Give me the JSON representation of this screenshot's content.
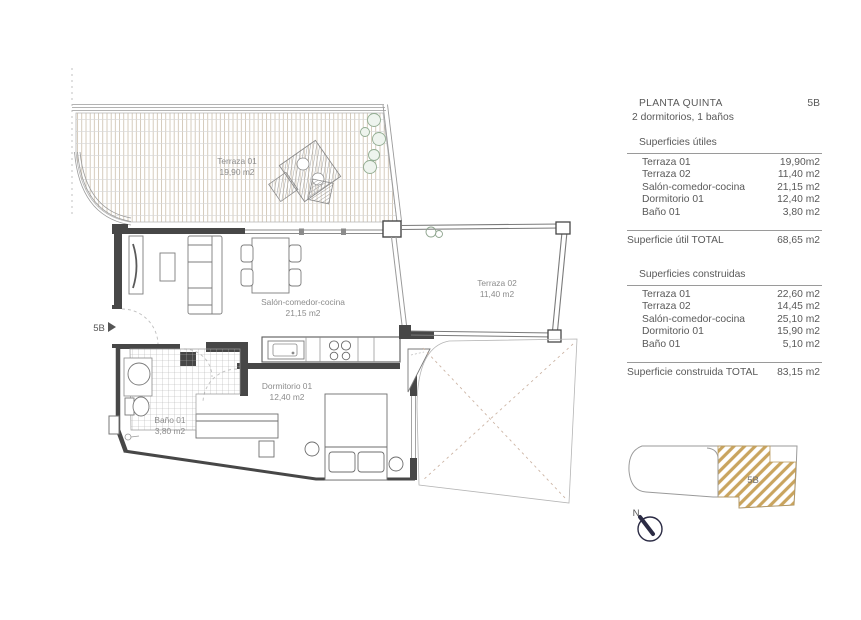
{
  "plan": {
    "entrance_unit_label": "5B",
    "north_label": "N",
    "rooms": {
      "terraza01": {
        "name": "Terraza 01",
        "area": "19,90 m2"
      },
      "terraza02": {
        "name": "Terraza 02",
        "area": "11,40 m2"
      },
      "salon": {
        "name": "Salón-comedor-cocina",
        "area": "21,15 m2"
      },
      "dormitorio": {
        "name": "Dormitorio 01",
        "area": "12,40 m2"
      },
      "bano": {
        "name": "Baño 01",
        "area": "3,80 m2"
      }
    }
  },
  "summary": {
    "title": "PLANTA QUINTA",
    "unit": "5B",
    "subtitle": "2 dormitorios, 1 baños",
    "useful": {
      "heading": "Superficies útiles",
      "rows": [
        {
          "label": "Terraza 01",
          "value": "19,90m2"
        },
        {
          "label": "Terraza 02",
          "value": "11,40 m2"
        },
        {
          "label": "Salón-comedor-cocina",
          "value": "21,15 m2"
        },
        {
          "label": "Dormitorio 01",
          "value": "12,40 m2"
        },
        {
          "label": "Baño 01",
          "value": "3,80 m2"
        }
      ],
      "total_label": "Superficie útil TOTAL",
      "total_value": "68,65 m2"
    },
    "built": {
      "heading": "Superficies construidas",
      "rows": [
        {
          "label": "Terraza 01",
          "value": "22,60 m2"
        },
        {
          "label": "Terraza 02",
          "value": "14,45 m2"
        },
        {
          "label": "Salón-comedor-cocina",
          "value": "25,10 m2"
        },
        {
          "label": "Dormitorio 01",
          "value": "15,90 m2"
        },
        {
          "label": "Baño 01",
          "value": "5,10 m2"
        }
      ],
      "total_label": "Superficie construida TOTAL",
      "total_value": "83,15 m2"
    }
  },
  "keyplan": {
    "unit_label": "5B",
    "hatch_color": "#c9a45e"
  },
  "colors": {
    "wall": "#474747",
    "thin_line": "#999999",
    "deck_line": "#c4b59f",
    "label_text": "#8c8c8c",
    "panel_text": "#595959",
    "plant_green": "#92ad92",
    "north_navy": "#2b2b44"
  }
}
